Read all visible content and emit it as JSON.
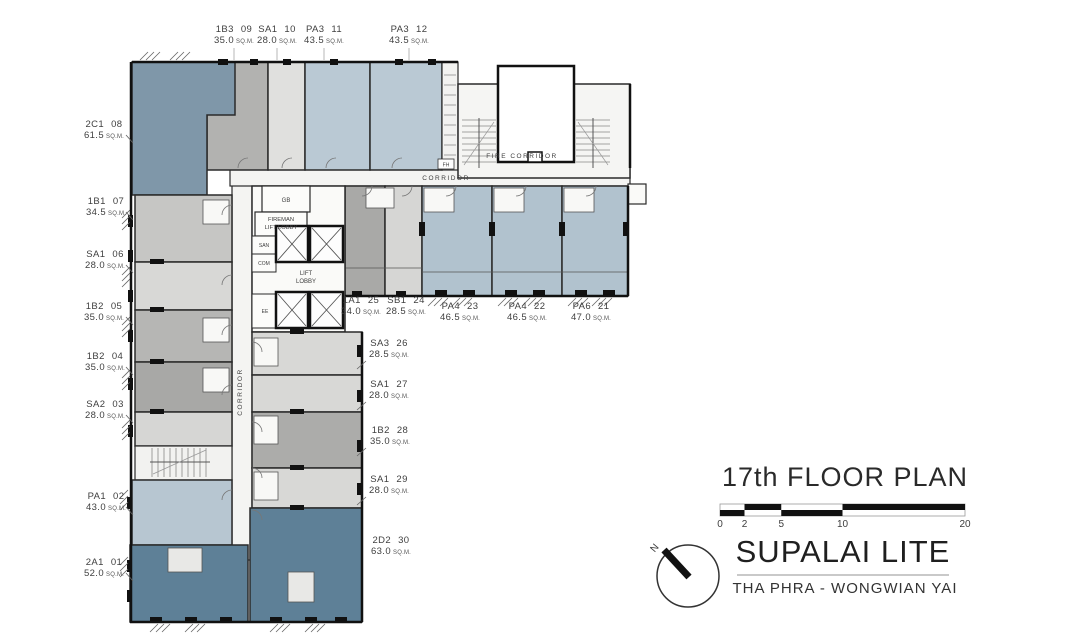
{
  "title_block": {
    "floor_title": "17th FLOOR PLAN",
    "scale_ticks": [
      "0",
      "2",
      "5",
      "10",
      "20"
    ],
    "north_label": "N",
    "project_name": "SUPALAI LITE",
    "project_location": "THA PHRA - WONGWIAN YAI"
  },
  "plan_labels": {
    "fire_corridor": "FIRE CORRIDOR",
    "corridor_h": "CORRIDOR",
    "corridor_v": "CORRIDOR",
    "gb": "GB",
    "fireman_line1": "FIREMAN",
    "fireman_line2": "LIFT LOBBY",
    "san": "SAN",
    "com": "COM",
    "lift_line1": "LIFT",
    "lift_line2": "LOBBY",
    "ee": "EE",
    "fh": "FH",
    "sqm": "SQ.M."
  },
  "units": [
    {
      "code": "2A1",
      "num": "01",
      "area": "52.0",
      "fill": "#5E8097"
    },
    {
      "code": "PA1",
      "num": "02",
      "area": "43.0",
      "fill": "#B7C6D1"
    },
    {
      "code": "SA2",
      "num": "03",
      "area": "28.0",
      "fill": "#D6D6D4"
    },
    {
      "code": "1B2",
      "num": "04",
      "area": "35.0",
      "fill": "#A8A8A6"
    },
    {
      "code": "1B2",
      "num": "05",
      "area": "35.0",
      "fill": "#B6B6B4"
    },
    {
      "code": "SA1",
      "num": "06",
      "area": "28.0",
      "fill": "#D8D8D6"
    },
    {
      "code": "1B1",
      "num": "07",
      "area": "34.5",
      "fill": "#C6C6C4"
    },
    {
      "code": "2C1",
      "num": "08",
      "area": "61.5",
      "fill": "#7F97A9"
    },
    {
      "code": "1B3",
      "num": "09",
      "area": "35.0",
      "fill": "#B2B2B0"
    },
    {
      "code": "SA1",
      "num": "10",
      "area": "28.0",
      "fill": "#E0E0DE"
    },
    {
      "code": "PA3",
      "num": "11",
      "area": "43.5",
      "fill": "#BAC9D4"
    },
    {
      "code": "PA3",
      "num": "12",
      "area": "43.5",
      "fill": "#BAC9D4"
    },
    {
      "code": "PA6",
      "num": "21",
      "area": "47.0",
      "fill": "#B1C2CE"
    },
    {
      "code": "PA4",
      "num": "22",
      "area": "46.5",
      "fill": "#B1C2CE"
    },
    {
      "code": "PA4",
      "num": "23",
      "area": "46.5",
      "fill": "#B1C2CE"
    },
    {
      "code": "SB1",
      "num": "24",
      "area": "28.5",
      "fill": "#D6D6D4"
    },
    {
      "code": "1A1",
      "num": "25",
      "area": "34.0",
      "fill": "#A9A9A7"
    },
    {
      "code": "SA3",
      "num": "26",
      "area": "28.5",
      "fill": "#D8D8D6"
    },
    {
      "code": "SA1",
      "num": "27",
      "area": "28.0",
      "fill": "#D8D8D6"
    },
    {
      "code": "1B2",
      "num": "28",
      "area": "35.0",
      "fill": "#ACACAA"
    },
    {
      "code": "SA1",
      "num": "29",
      "area": "28.0",
      "fill": "#D8D8D6"
    },
    {
      "code": "2D2",
      "num": "30",
      "area": "63.0",
      "fill": "#5E8097"
    }
  ],
  "colors": {
    "wall": "#1F1F1F",
    "corridor": "#F4F4F2",
    "slate": "#7F97A9",
    "slate_dark": "#5E8097",
    "blue_light": "#BAC9D4",
    "blue_mid": "#B1C2CE",
    "gray_dark": "#A8A8A6",
    "gray_pale": "#D8D8D6"
  }
}
